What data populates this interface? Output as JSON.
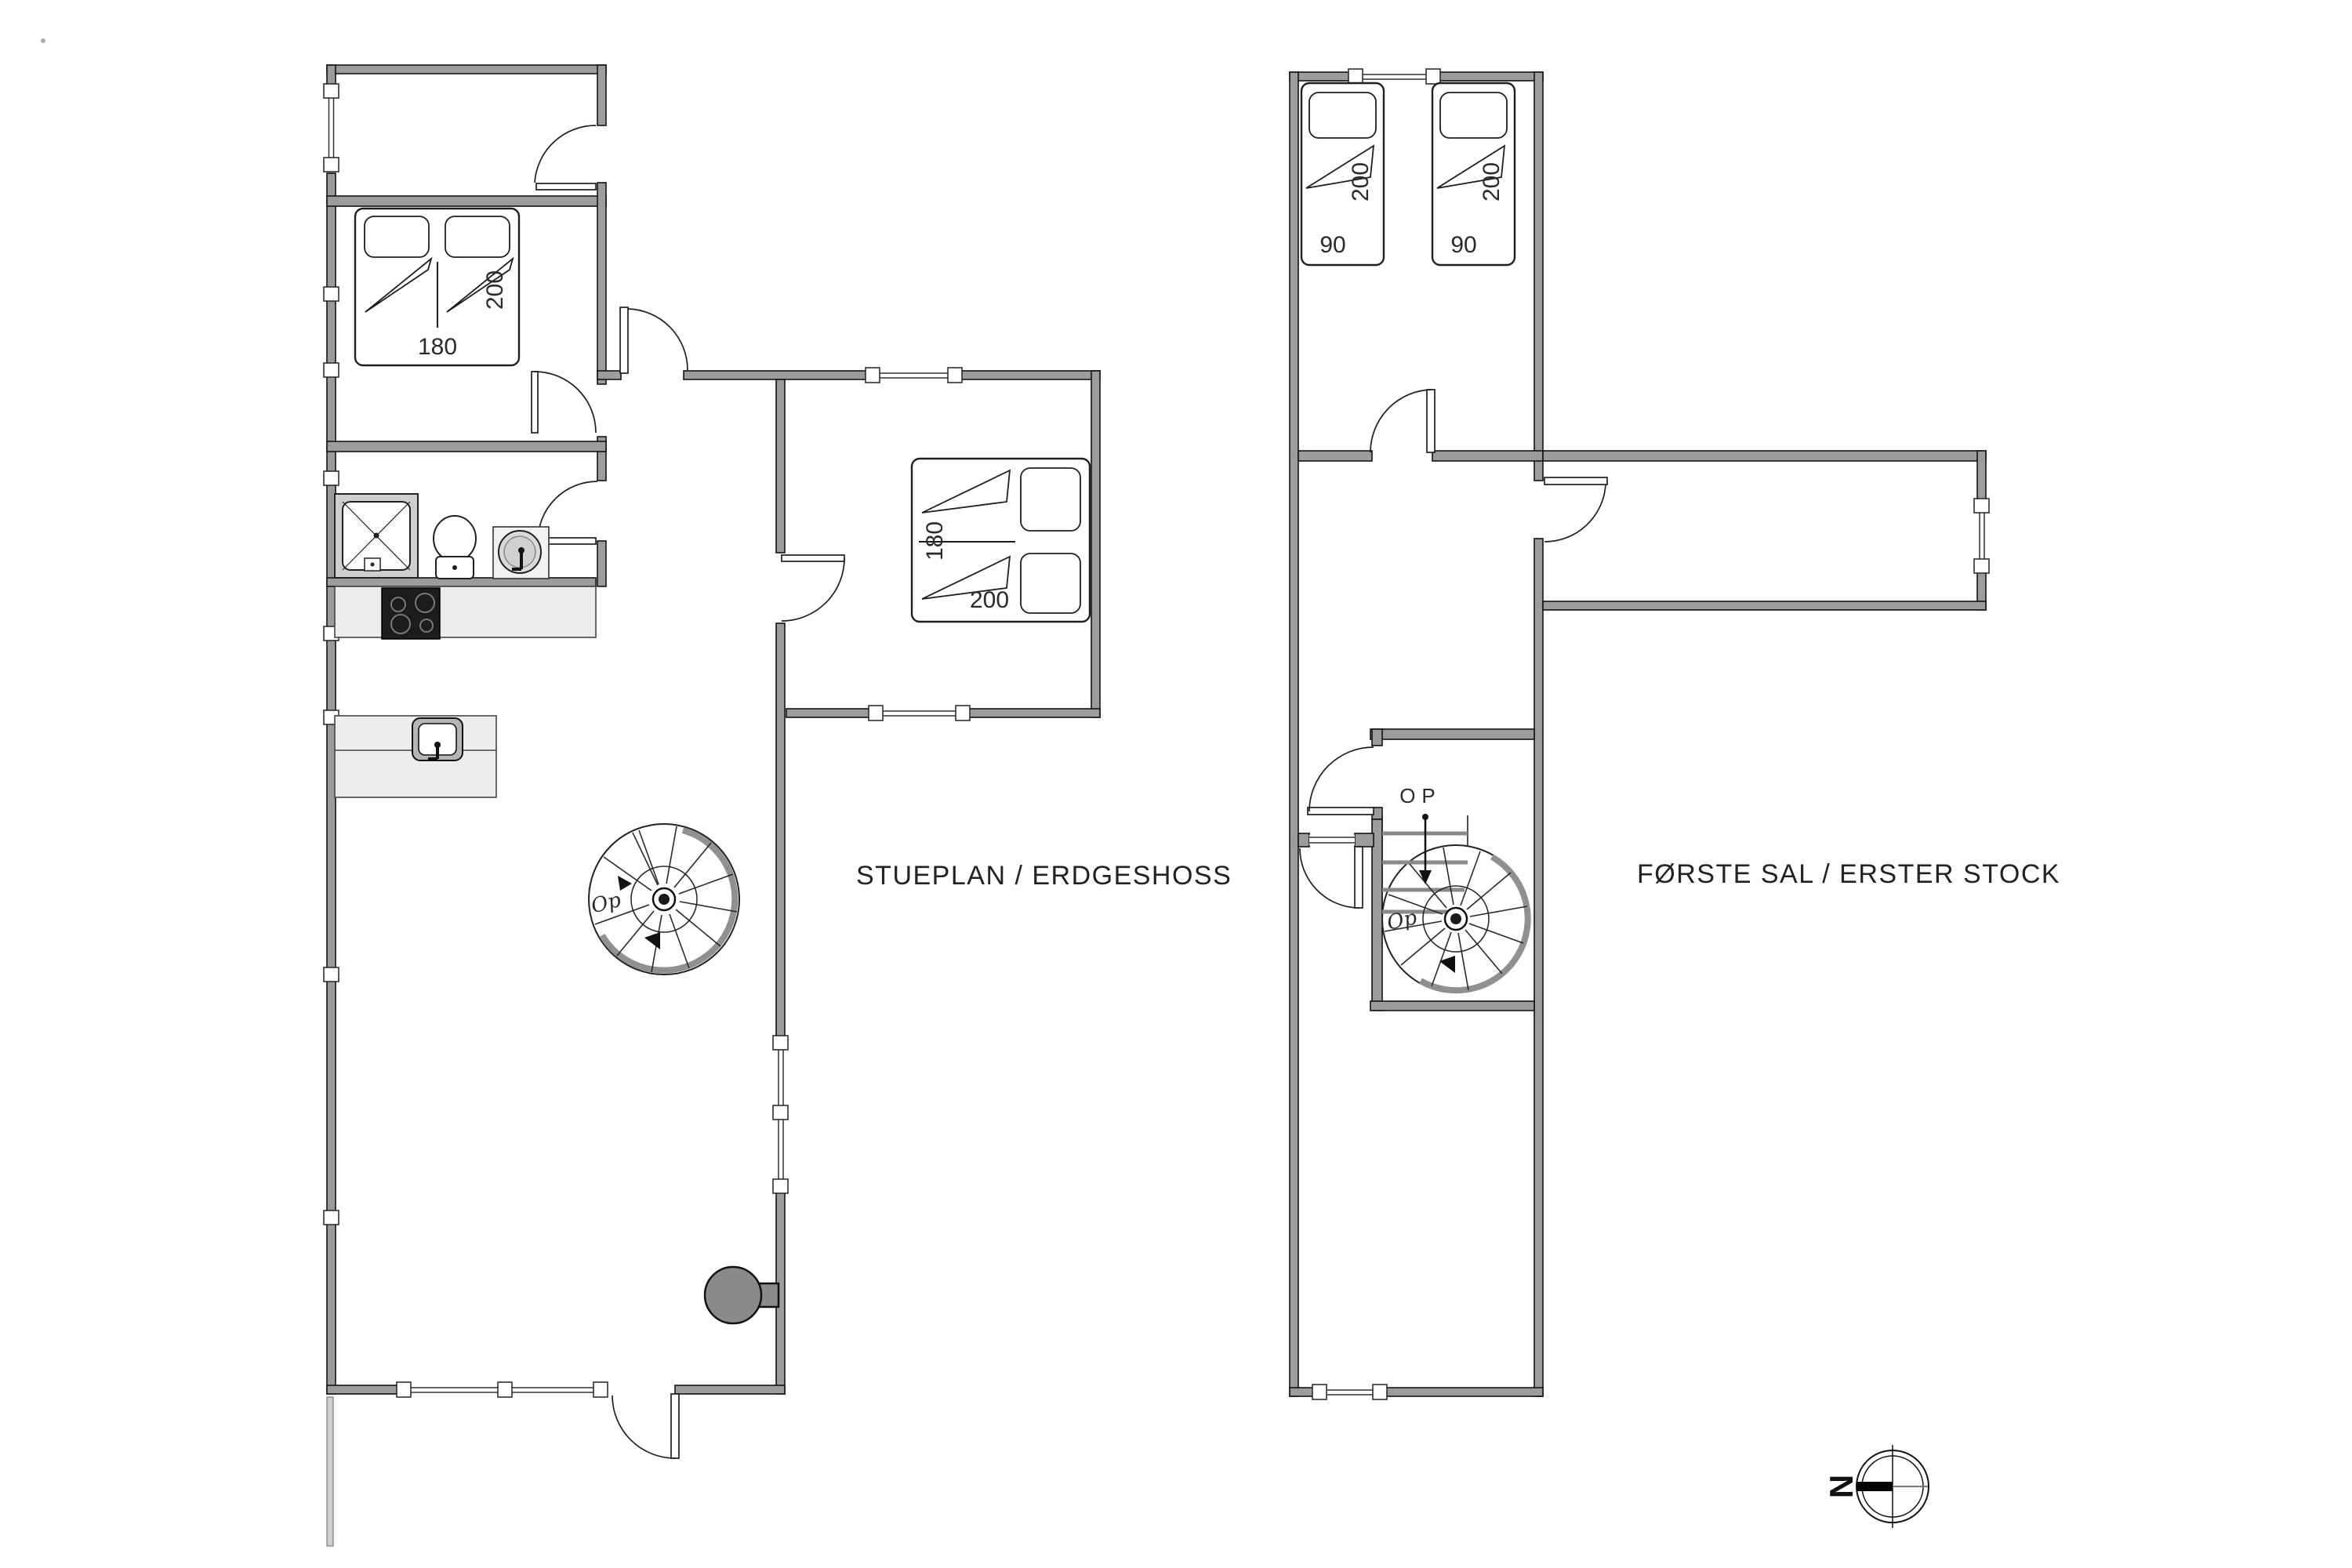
{
  "page": {
    "background": "#ffffff"
  },
  "floorplans": {
    "ground": {
      "title": "STUEPLAN / ERDGESHOSS",
      "double_bed_nw": {
        "width": "180",
        "length": "200"
      },
      "double_bed_east": {
        "width": "180",
        "length": "200"
      },
      "spiral_stairs": {
        "up_label": "Op"
      }
    },
    "first": {
      "title": "FØRSTE SAL / ERSTER STOCK",
      "single_bed_left": {
        "width": "90",
        "length": "200"
      },
      "single_bed_right": {
        "width": "90",
        "length": "200"
      },
      "spiral_stairs": {
        "up_label": "Op",
        "direction_label": "OP"
      }
    }
  },
  "compass": {
    "north_label": "N"
  },
  "colors": {
    "wall_fill": "#9c9c9c",
    "wall_outline": "#141414",
    "fixture_fill": "#ededed",
    "cooktop_fill": "#1c1c1c",
    "wood_stove_fill": "#8a8a8a",
    "label_text": "#2a2a2a"
  }
}
